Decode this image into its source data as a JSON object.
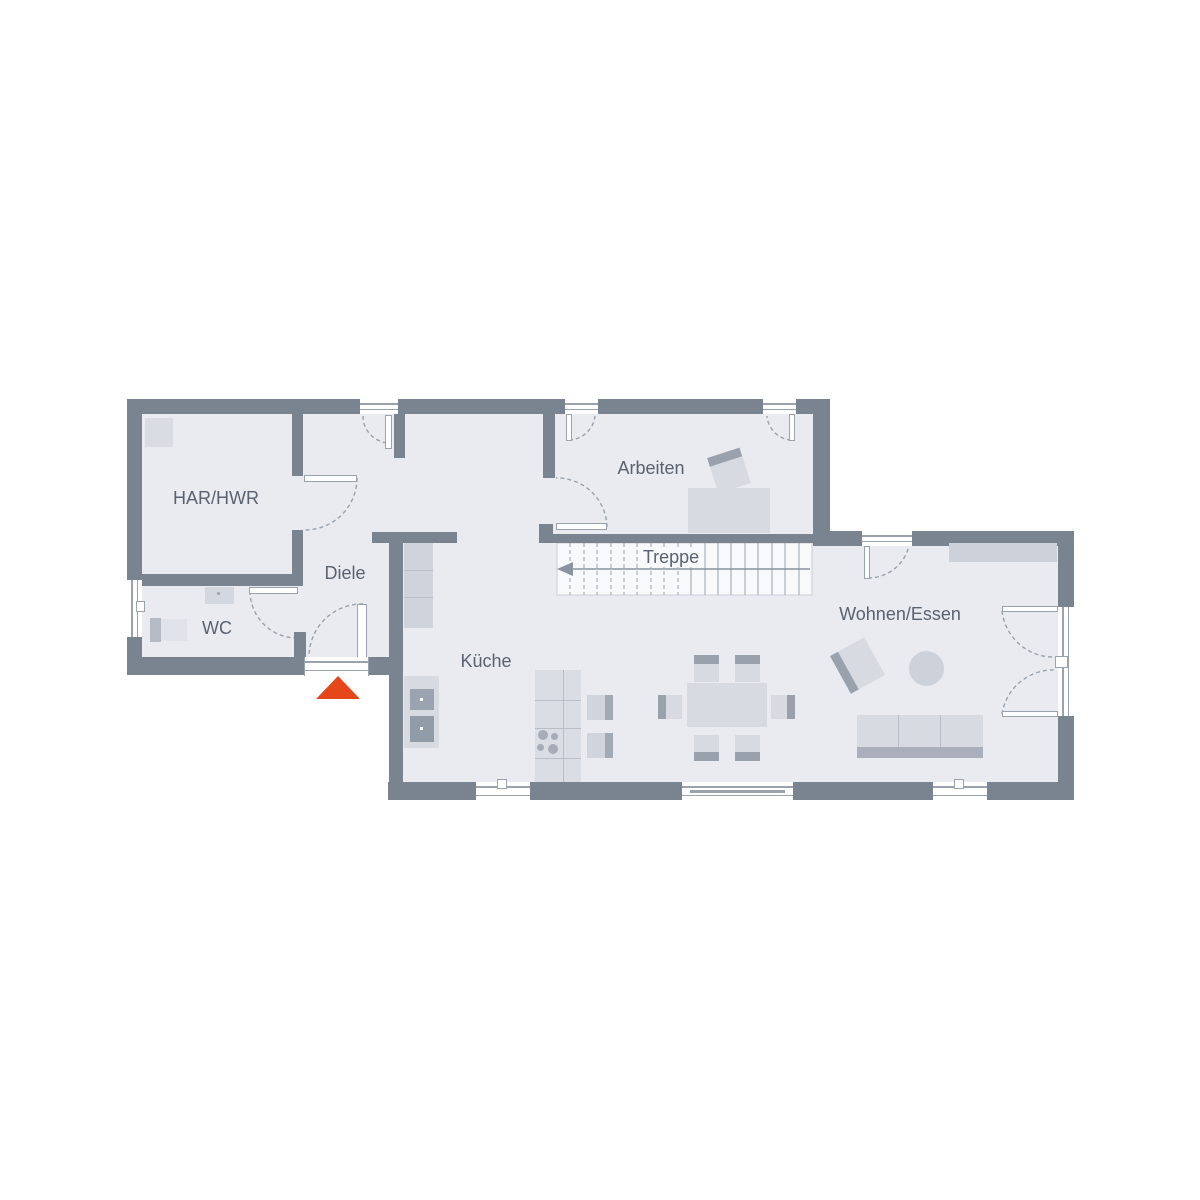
{
  "plan": {
    "rooms": {
      "har_hwr": "HAR/HWR",
      "wc": "WC",
      "diele": "Diele",
      "arbeiten": "Arbeiten",
      "kueche": "Küche",
      "wohnen_essen": "Wohnen/Essen"
    },
    "stairs": {
      "label": "Treppe",
      "direction_arrow": "left"
    },
    "entrance": {
      "marker": "red-triangle"
    },
    "colors": {
      "wall": "#7A8390",
      "floor": "#E9EBF0",
      "stair_fill": "#F7F9FB",
      "furniture_light": "#D7DAE1",
      "furniture_soft": "#CDD2DA",
      "furniture_mid": "#B4BBC5",
      "furniture_dark": "#99A1AD",
      "line": "#9AA2AE",
      "grid_line": "#A9B0BB",
      "text": "#5A6270",
      "accent": "#E5461A"
    }
  }
}
